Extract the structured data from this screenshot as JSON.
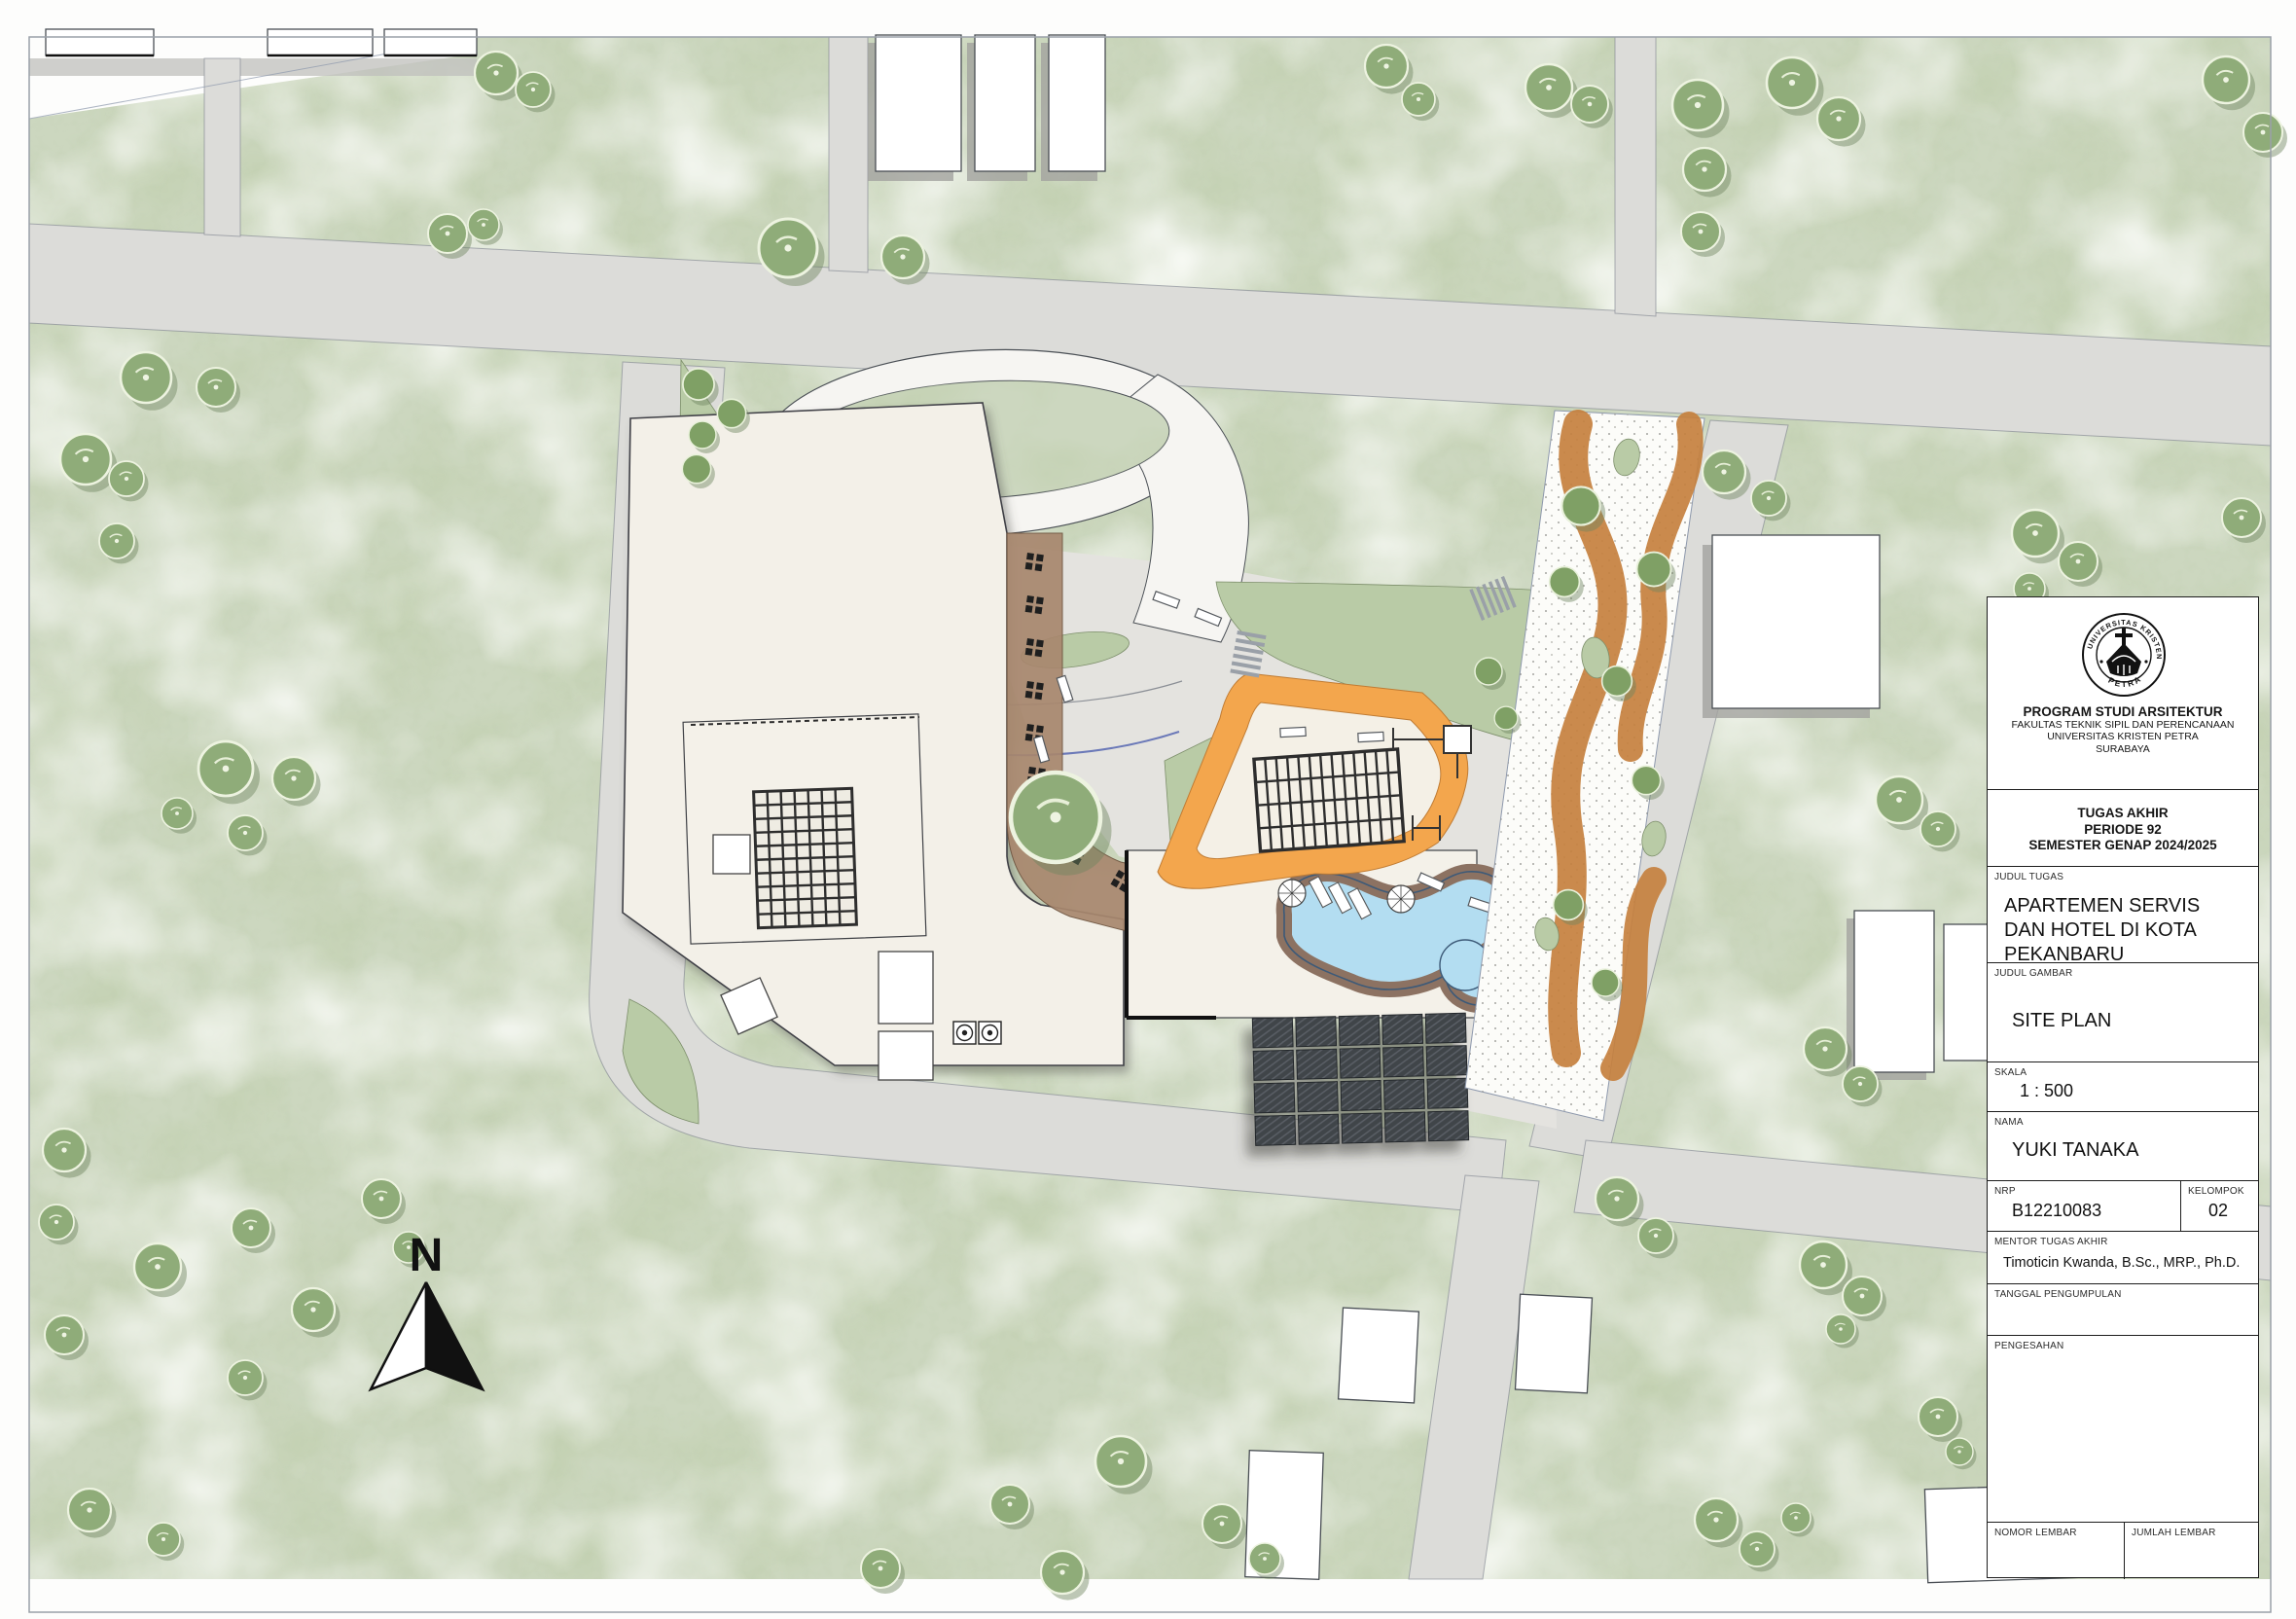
{
  "map": {
    "north_label": "N",
    "colors": {
      "grass": "#ccd7bf",
      "grass_mottle": "#95aa7b",
      "road": "#dcdcd9",
      "building_fill": "#ffffff",
      "podium_cream": "#f3f0e8",
      "terrace_brown": "#a8876e",
      "playground_orange": "#f3a64d",
      "garden_path_orange": "#c6813f",
      "pool_blue": "#b3ddf1",
      "pool_deck": "#8c7262",
      "solar_dark": "#41454a"
    },
    "features": {
      "site": "apartment and hotel complex with oval drop-off loop",
      "pool": "kidney-shaped swimming pool with deck",
      "playground": "orange jogging loop with canopy grid",
      "solar": "rooftop solar panel array 5 x 4"
    }
  },
  "title_block": {
    "institution": {
      "logo_top": "UNIVERSITAS KRISTEN",
      "logo_bottom": "PETRA",
      "program": "PROGRAM STUDI ARSITEKTUR",
      "faculty": "FAKULTAS TEKNIK SIPIL DAN PERENCANAAN",
      "university": "UNIVERSITAS KRISTEN PETRA",
      "city": "SURABAYA"
    },
    "project": {
      "line1": "TUGAS AKHIR",
      "line2": "PERIODE 92",
      "line3": "SEMESTER GENAP 2024/2025"
    },
    "fields": {
      "judul_tugas_label": "JUDUL TUGAS",
      "judul_tugas_lines": [
        "APARTEMEN SERVIS",
        "DAN HOTEL DI KOTA",
        "PEKANBARU"
      ],
      "judul_gambar_label": "JUDUL GAMBAR",
      "judul_gambar": "SITE PLAN",
      "skala_label": "SKALA",
      "skala": "1 : 500",
      "nama_label": "NAMA",
      "nama": "YUKI TANAKA",
      "nrp_label": "NRP",
      "nrp": "B12210083",
      "kelompok_label": "KELOMPOK",
      "kelompok": "02",
      "mentor_label": "MENTOR TUGAS AKHIR",
      "mentor": "Timoticin Kwanda, B.Sc., MRP., Ph.D.",
      "tanggal_label": "TANGGAL PENGUMPULAN",
      "pengesahan_label": "PENGESAHAN",
      "nomor_label": "NOMOR LEMBAR",
      "jumlah_label": "JUMLAH LEMBAR"
    }
  }
}
